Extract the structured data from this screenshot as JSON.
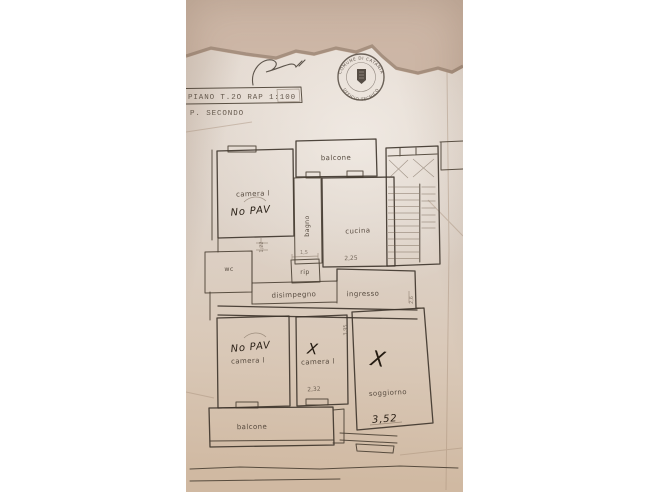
{
  "header": {
    "title": "PIANO T.2O RAP 1:100",
    "subtitle": "P. SECONDO"
  },
  "stamp": {
    "top_text": "COMUNE DI CATANIA",
    "bottom_text": "UFFICIO TECNICO"
  },
  "plan": {
    "rooms": {
      "balcone_top": "balcone",
      "camera_top": "camera l",
      "bagno": "bagno",
      "cucina": "cucina",
      "wc": "wc",
      "rip": "rip",
      "disimpegno": "disimpegno",
      "ingresso": "ingresso",
      "camera_bottom_left": "camera l",
      "camera_bottom_mid": "camera l",
      "soggiorno": "soggiorno",
      "balcone_bottom": "balcone"
    },
    "annotations": {
      "no_pav_top": "No PAV",
      "no_pav_bottom": "No PAV",
      "x_camera": "X",
      "x_soggiorno": "X"
    },
    "measurements": {
      "cucina": "2,25",
      "rip": "1,5",
      "ingresso": "2,6",
      "camera_mid": "2,32",
      "soggiorno": "3,52",
      "wc_side": "1,22",
      "soggiorno_side": "3,95"
    }
  },
  "colors": {
    "wall_tan": "#c8b1a0",
    "paper": "#ddd2c8",
    "ink": "#463c31",
    "pen": "#2b2218"
  }
}
